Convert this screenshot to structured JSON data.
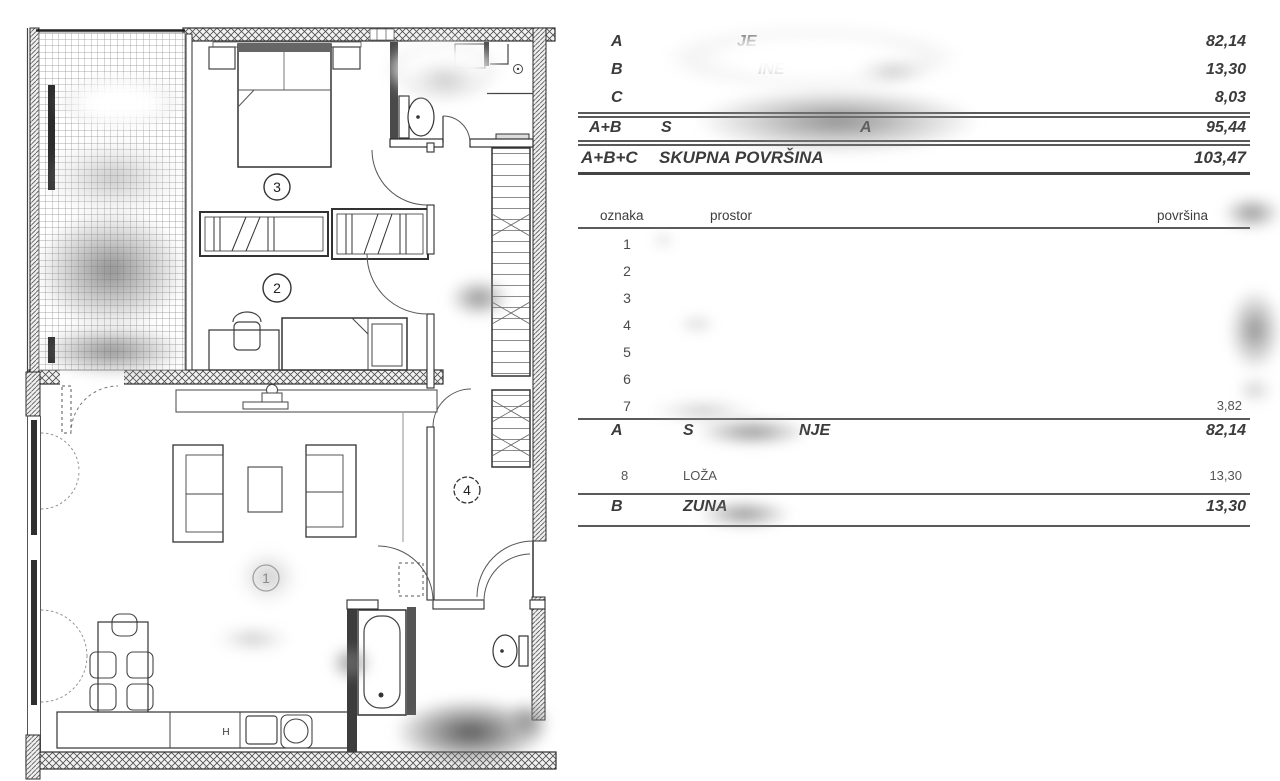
{
  "plan": {
    "room_labels": {
      "living": "1",
      "bedroom2": "2",
      "bedroom3": "3",
      "hall": "4"
    },
    "kitchen_symbol": "H"
  },
  "summary": {
    "rows": [
      {
        "code": "A",
        "fragment": "JE",
        "value": "82,14"
      },
      {
        "code": "B",
        "fragment": "INE",
        "value": "13,30"
      },
      {
        "code": "C",
        "fragment": "",
        "value": "8,03"
      },
      {
        "code": "A+B",
        "fragment_start": "S",
        "fragment_end": "A",
        "value": "95,44"
      },
      {
        "code": "A+B+C",
        "label": "SKUPNA POVRŠINA",
        "value": "103,47"
      }
    ]
  },
  "rooms": {
    "headers": {
      "code": "oznaka",
      "name": "prostor",
      "area": "površina"
    },
    "rows": [
      {
        "code": "1",
        "name": "",
        "area": ""
      },
      {
        "code": "2",
        "name": "",
        "area": ""
      },
      {
        "code": "3",
        "name": "",
        "area": ""
      },
      {
        "code": "4",
        "name": "",
        "area": ""
      },
      {
        "code": "5",
        "name": "",
        "area": ""
      },
      {
        "code": "6",
        "name": "",
        "area": ""
      },
      {
        "code": "7",
        "name": "",
        "area": "3,82"
      }
    ],
    "subtotal": {
      "code": "A",
      "fragment_start": "S",
      "fragment_end": "NJE",
      "value": "82,14"
    },
    "outdoor": {
      "code": "8",
      "name": "LOŽA",
      "area": "13,30"
    },
    "outdoor_total": {
      "code": "B",
      "fragment": "ZUNA",
      "value": "13,30"
    }
  },
  "colors": {
    "text": "#3b3b3b",
    "line": "#5a5a5a",
    "wall": "#2e2e2e"
  }
}
